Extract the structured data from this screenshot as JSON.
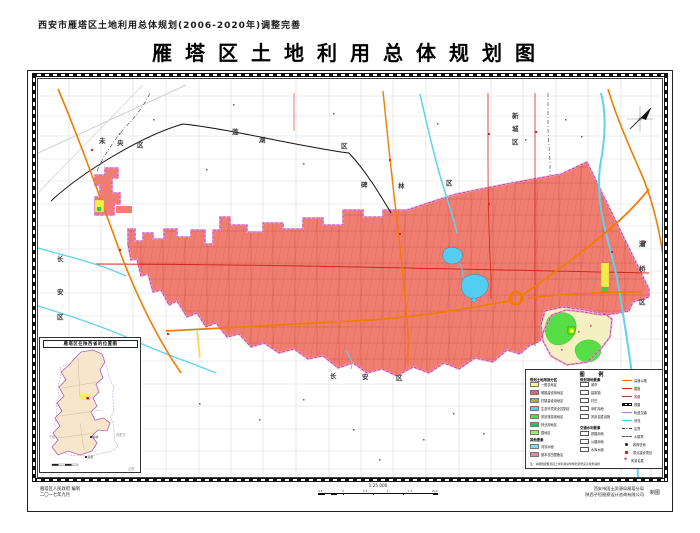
{
  "header": {
    "subtitle": "西安市雁塔区土地利用总体规划(2006-2020年)调整完善",
    "title": "雁塔区土地利用总体规划图"
  },
  "map": {
    "district_chars": [
      {
        "t": "未",
        "x": 98,
        "y": 137
      },
      {
        "t": "央",
        "x": 116,
        "y": 139
      },
      {
        "t": "区",
        "x": 136,
        "y": 141
      },
      {
        "t": "莲",
        "x": 231,
        "y": 128
      },
      {
        "t": "湖",
        "x": 258,
        "y": 136
      },
      {
        "t": "区",
        "x": 340,
        "y": 142
      },
      {
        "t": "新",
        "x": 511,
        "y": 112
      },
      {
        "t": "城",
        "x": 511,
        "y": 125
      },
      {
        "t": "区",
        "x": 511,
        "y": 138
      },
      {
        "t": "碑",
        "x": 360,
        "y": 181
      },
      {
        "t": "林",
        "x": 397,
        "y": 182
      },
      {
        "t": "区",
        "x": 445,
        "y": 179
      },
      {
        "t": "灞",
        "x": 638,
        "y": 240
      },
      {
        "t": "桥",
        "x": 638,
        "y": 265
      },
      {
        "t": "区",
        "x": 638,
        "y": 298
      },
      {
        "t": "长",
        "x": 56,
        "y": 255
      },
      {
        "t": "安",
        "x": 56,
        "y": 288
      },
      {
        "t": "区",
        "x": 56,
        "y": 313
      },
      {
        "t": "长",
        "x": 329,
        "y": 372
      },
      {
        "t": "安",
        "x": 361,
        "y": 373
      },
      {
        "t": "区",
        "x": 395,
        "y": 374
      }
    ],
    "colors": {
      "urban_zone": "#f07e70",
      "boundary_halo": "#e896e4",
      "boundary_dash": "#b03050",
      "highway": "#ef7d00",
      "river": "#5fd2ee",
      "lake": "#54cdf0",
      "scenic_green": "#57de46",
      "pale_farm": "#f4f0c2",
      "yellow_patch": "#f7f03e",
      "railway": "#111111"
    }
  },
  "legend": {
    "title": "图  例",
    "note": "注：本图根据雁塔区土地利用总体规划调整完善成果编制",
    "col1": {
      "header": "规划土地用途分区",
      "items": [
        {
          "c": "#ffff70",
          "hatch": false,
          "label": "一般农地区"
        },
        {
          "c": "#f2796b",
          "hatch": true,
          "label": "城镇建设用地区"
        },
        {
          "c": "#ffb03a",
          "hatch": true,
          "label": "村镇建设用地区"
        },
        {
          "c": "#4fd0ee",
          "hatch": false,
          "label": "生态环境安全控制区"
        },
        {
          "c": "#4ade4a",
          "hatch": false,
          "label": "风景旅游用地区"
        },
        {
          "c": "#16c860",
          "hatch": false,
          "label": "林业用地区"
        },
        {
          "c": "#a0ec6a",
          "hatch": false,
          "label": "园地区"
        }
      ],
      "header2": "其他要素",
      "items2": [
        {
          "c": "#74e0f2",
          "hatch": false,
          "label": "河流水面"
        },
        {
          "c": "#f080a8",
          "hatch": false,
          "label": "基本农田整备区"
        }
      ]
    },
    "col2": {
      "header": "规划用地要素",
      "items": [
        {
          "label": "城市"
        },
        {
          "label": "建制镇"
        },
        {
          "label": "村庄"
        },
        {
          "label": "采矿用地"
        },
        {
          "label": "风景名胜设施"
        }
      ],
      "header2": "交通水利要素",
      "items2": [
        {
          "label": "铁路用地"
        },
        {
          "label": "公路用地"
        },
        {
          "label": "水库水面"
        }
      ]
    },
    "col3": {
      "items": [
        {
          "type": "line",
          "c": "#e87600",
          "label": "高速公路"
        },
        {
          "type": "line",
          "c": "#d8261c",
          "label": "国道"
        },
        {
          "type": "line",
          "c": "#8a4b22",
          "label": "省道"
        },
        {
          "type": "rail",
          "c": "#111111",
          "label": "铁路"
        },
        {
          "type": "line",
          "c": "#c06ae0",
          "label": "轨道交通"
        },
        {
          "type": "line",
          "c": "#49c8ee",
          "label": "河流"
        },
        {
          "type": "dashdot",
          "c": "#333333",
          "label": "区界"
        },
        {
          "type": "dash",
          "c": "#666666",
          "label": "乡镇界"
        },
        {
          "type": "dot",
          "c": "#222222",
          "label": "政府驻地"
        },
        {
          "type": "sq",
          "c": "#e02020",
          "label": "重点建设项目"
        },
        {
          "type": "star",
          "c": "#d02020",
          "label": "风景名胜"
        }
      ]
    }
  },
  "inset": {
    "title": "雁塔区在陕西省的位置图",
    "neighbors": [
      {
        "t": "内蒙古",
        "x": 76,
        "y": 96
      },
      {
        "t": "山西",
        "x": 88,
        "y": 130
      },
      {
        "t": "河南",
        "x": 90,
        "y": 167
      },
      {
        "t": "湖北",
        "x": 72,
        "y": 198
      },
      {
        "t": "四川",
        "x": 22,
        "y": 200
      },
      {
        "t": "甘肃",
        "x": 7,
        "y": 140
      },
      {
        "t": "宁夏",
        "x": 9,
        "y": 98
      }
    ],
    "cities": [
      {
        "t": "榆林",
        "x": 50,
        "y": 98,
        "red": false
      },
      {
        "t": "延安",
        "x": 45,
        "y": 118,
        "red": false
      },
      {
        "t": "西安",
        "x": 48,
        "y": 158,
        "red": true
      },
      {
        "t": "渭南",
        "x": 62,
        "y": 152,
        "red": false
      },
      {
        "t": "汉中",
        "x": 20,
        "y": 180,
        "red": false
      },
      {
        "t": "安康",
        "x": 44,
        "y": 188,
        "red": false
      }
    ]
  },
  "footer": {
    "credit_left1": "雁塔区人民政府  编制",
    "credit_left2": "二〇一七年九月",
    "scale_label": "1:25 000",
    "scale_ticks": [
      "0.5",
      "0",
      "0.5",
      "1",
      "1.5",
      "2km"
    ],
    "credit_right1": "西安市国土资源局雁塔分局",
    "credit_right2": "陕西子恒勘察设计咨询有限公司",
    "credit_right_suffix": "制图"
  }
}
